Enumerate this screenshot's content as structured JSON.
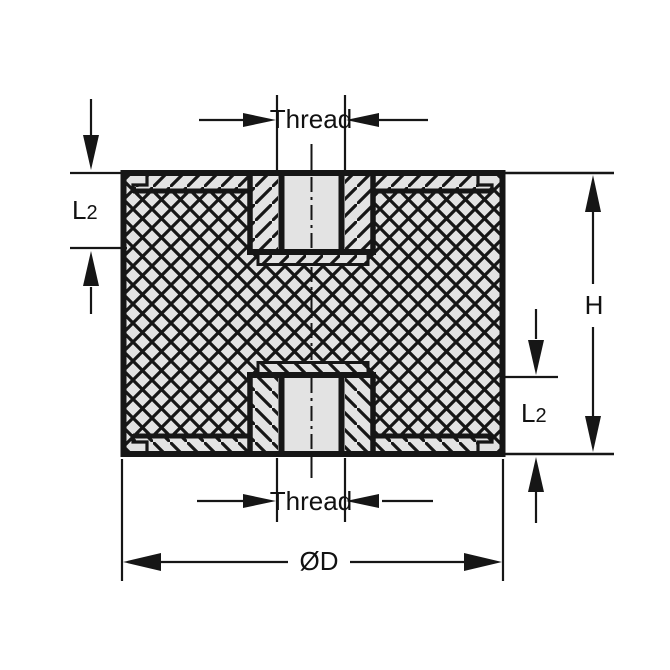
{
  "drawing": {
    "type": "engineering-cross-section",
    "subject": "cylindrical rubber mount with threaded inserts (section view)",
    "labels": {
      "thread_top": "Thread",
      "thread_bottom": "Thread",
      "l2_top": {
        "base": "L",
        "sub": "2"
      },
      "l2_bottom": {
        "base": "L",
        "sub": "2"
      },
      "height": "H",
      "diameter": "ØD"
    },
    "colors": {
      "line": "#161616",
      "fill": "#e3e3e3",
      "background": "#ffffff"
    }
  }
}
